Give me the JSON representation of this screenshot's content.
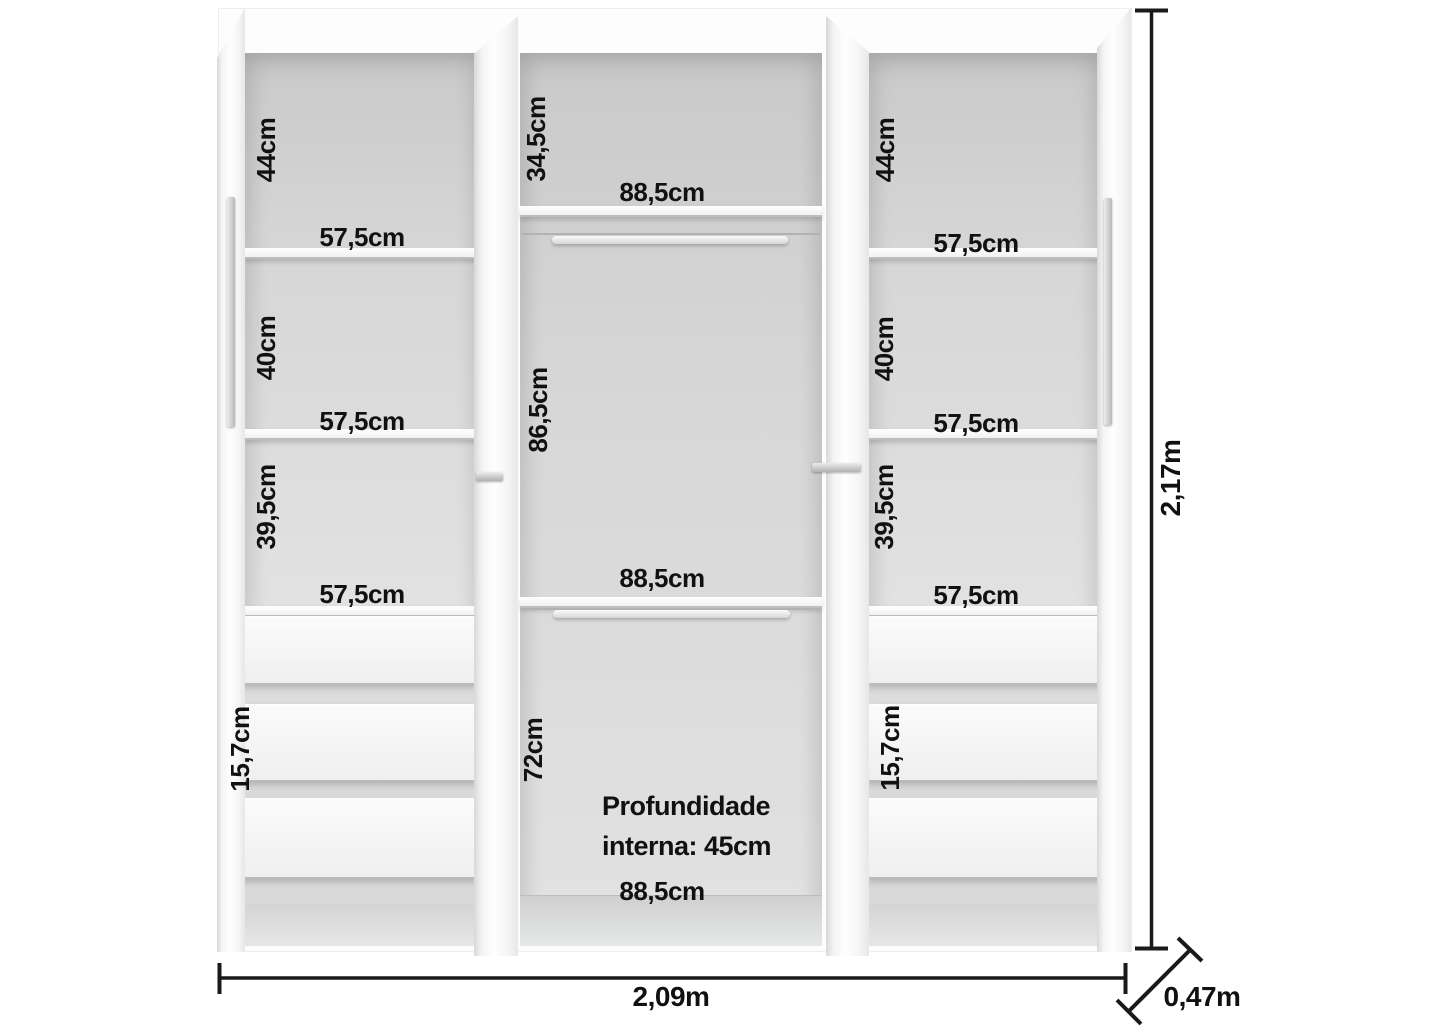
{
  "wardrobe": {
    "left_column": {
      "section1_height": "44cm",
      "shelf1_width": "57,5cm",
      "section2_height": "40cm",
      "shelf2_width": "57,5cm",
      "section3_height": "39,5cm",
      "shelf3_width": "57,5cm",
      "drawer_height": "15,7cm"
    },
    "middle_column": {
      "top_section_height": "34,5cm",
      "top_shelf_width": "88,5cm",
      "hanging_section_height": "86,5cm",
      "middle_shelf_width": "88,5cm",
      "lower_section_height": "72cm",
      "internal_depth_line1": "Profundidade",
      "internal_depth_line2": "interna: 45cm",
      "bottom_width": "88,5cm"
    },
    "right_column": {
      "section1_height": "44cm",
      "shelf1_width": "57,5cm",
      "section2_height": "40cm",
      "shelf2_width": "57,5cm",
      "section3_height": "39,5cm",
      "shelf3_width": "57,5cm",
      "drawer_height": "15,7cm"
    },
    "overall_dimensions": {
      "height": "2,17m",
      "width": "2,09m",
      "depth": "0,47m"
    },
    "colors": {
      "interior_gray": "#d6d6d6",
      "dimension_line": "#1a1a1a",
      "label_text": "#111111"
    }
  }
}
